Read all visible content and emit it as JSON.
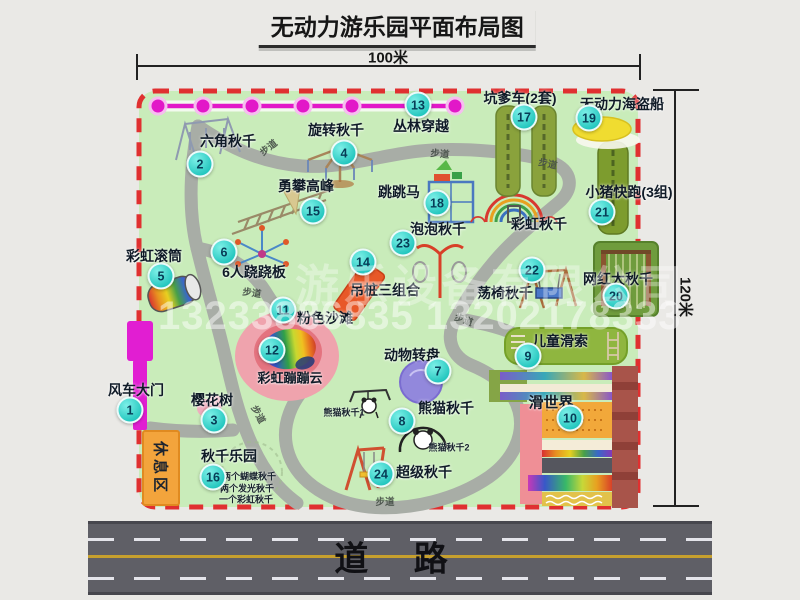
{
  "title": "无动力游乐园平面布局图",
  "dimensions": {
    "width": "100米",
    "height": "120米"
  },
  "rest_area_label": "休息区",
  "road_label": "道 路",
  "watermark": {
    "line1": "游乐设备有限公司",
    "line2": "13233886835 13202178333"
  },
  "path_label_text": "步道",
  "path_labels": [
    {
      "x": 268,
      "y": 147,
      "rot": -38
    },
    {
      "x": 440,
      "y": 153,
      "rot": 5
    },
    {
      "x": 548,
      "y": 163,
      "rot": 12
    },
    {
      "x": 252,
      "y": 292,
      "rot": 8
    },
    {
      "x": 464,
      "y": 319,
      "rot": 20
    },
    {
      "x": 259,
      "y": 414,
      "rot": 62
    },
    {
      "x": 385,
      "y": 501,
      "rot": 0
    }
  ],
  "features": [
    {
      "num": "1",
      "label": "风车大门",
      "lx": 136,
      "ly": 390,
      "bx": 130,
      "by": 410
    },
    {
      "num": "2",
      "label": "六角秋千",
      "lx": 228,
      "ly": 141,
      "bx": 200,
      "by": 164
    },
    {
      "num": "3",
      "label": "樱花树",
      "lx": 212,
      "ly": 400,
      "bx": 214,
      "by": 420
    },
    {
      "num": "4",
      "label": "旋转秋千",
      "lx": 336,
      "ly": 130,
      "bx": 344,
      "by": 153
    },
    {
      "num": "5",
      "label": "彩虹滚筒",
      "lx": 154,
      "ly": 256,
      "bx": 161,
      "by": 276
    },
    {
      "num": "6",
      "label": "6人跷跷板",
      "lx": 254,
      "ly": 272,
      "bx": 224,
      "by": 252
    },
    {
      "num": "7",
      "label": "动物转盘",
      "lx": 412,
      "ly": 355,
      "bx": 438,
      "by": 371
    },
    {
      "num": "8",
      "label": "熊猫秋千",
      "lx": 446,
      "ly": 408,
      "bx": 402,
      "by": 421,
      "subs": [
        {
          "t": "熊猫秋千1",
          "x": 344,
          "y": 412
        },
        {
          "t": "熊猫秋千2",
          "x": 449,
          "y": 447
        }
      ]
    },
    {
      "num": "9",
      "label": "儿童滑索",
      "lx": 560,
      "ly": 341,
      "bx": 528,
      "by": 356
    },
    {
      "num": "10",
      "label": "滑世界",
      "lx": 551,
      "ly": 402,
      "bx": 570,
      "by": 418,
      "ls": 15
    },
    {
      "num": "11",
      "label": "粉色沙滩",
      "lx": 325,
      "ly": 318,
      "bx": 283,
      "by": 310
    },
    {
      "num": "12",
      "label": "彩虹蹦蹦云",
      "lx": 290,
      "ly": 377,
      "bx": 272,
      "by": 350,
      "ls": 13
    },
    {
      "num": "13",
      "label": "丛林穿越",
      "lx": 421,
      "ly": 126,
      "bx": 418,
      "by": 105
    },
    {
      "num": "14",
      "label": "吊桩三组合",
      "lx": 385,
      "ly": 290,
      "bx": 363,
      "by": 262
    },
    {
      "num": "15",
      "label": "勇攀高峰",
      "lx": 306,
      "ly": 186,
      "bx": 313,
      "by": 211
    },
    {
      "num": "16",
      "label": "秋千乐园",
      "lx": 229,
      "ly": 456,
      "bx": 213,
      "by": 477,
      "subs": [
        {
          "t": "两个蝴蝶秋千",
          "x": 249,
          "y": 476
        },
        {
          "t": "两个发光秋千",
          "x": 247,
          "y": 488
        },
        {
          "t": "一个彩虹秋千",
          "x": 246,
          "y": 499
        }
      ]
    },
    {
      "num": "17",
      "label": "坑爹车(2套)",
      "lx": 520,
      "ly": 98,
      "bx": 524,
      "by": 117
    },
    {
      "num": "18",
      "label": "跳跳马",
      "lx": 399,
      "ly": 192,
      "bx": 437,
      "by": 203
    },
    {
      "num": "19",
      "label": "无动力海盗船",
      "lx": 622,
      "ly": 104,
      "bx": 589,
      "by": 118
    },
    {
      "num": "20",
      "label": "网红大秋千",
      "lx": 618,
      "ly": 279,
      "bx": 616,
      "by": 296
    },
    {
      "num": "21",
      "label": "小猪快跑(3组)",
      "lx": 629,
      "ly": 192,
      "bx": 602,
      "by": 212
    },
    {
      "num": "22",
      "label": "荡椅秋千",
      "lx": 505,
      "ly": 293,
      "bx": 532,
      "by": 270
    },
    {
      "num": "23",
      "label": "泡泡秋千",
      "lx": 438,
      "ly": 229,
      "bx": 403,
      "by": 243
    },
    {
      "num": "24",
      "label": "超级秋千",
      "lx": 424,
      "ly": 472,
      "bx": 381,
      "by": 474
    },
    {
      "label": "彩虹秋千",
      "lx": 539,
      "ly": 224
    }
  ],
  "colors": {
    "park_green": "#c9ecba",
    "boundary_red": "#e03030",
    "zipline_magenta": "#e218c8",
    "badge_teal": "#23c6be",
    "path_gray": "#a8ada6",
    "road_gray": "#5f5f66",
    "rest_area_orange": "#f3a43c"
  }
}
